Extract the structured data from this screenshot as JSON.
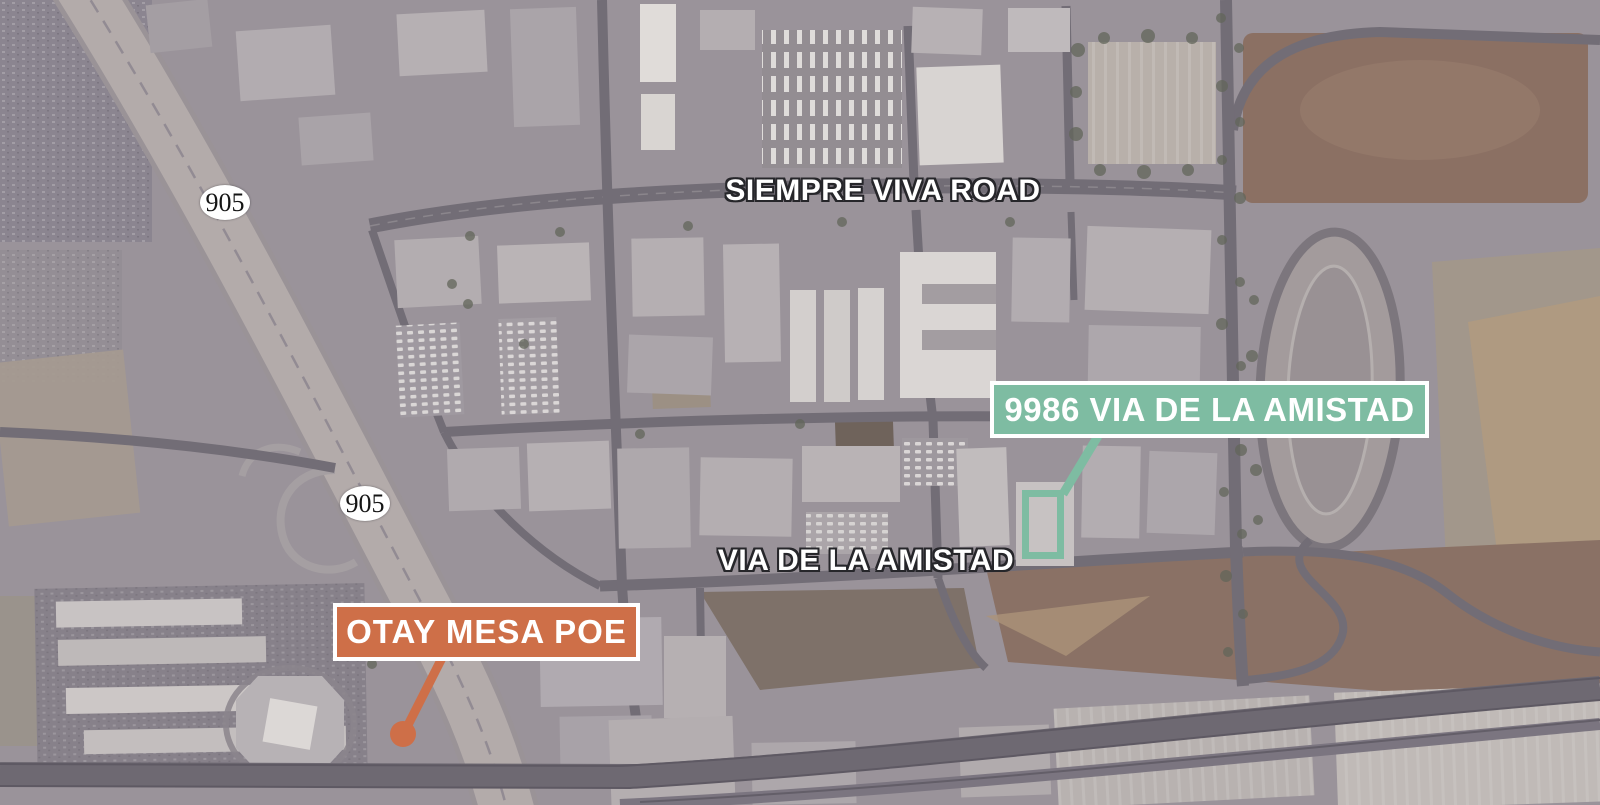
{
  "map": {
    "type": "aerial-satellite",
    "street_labels": [
      {
        "id": "siempre-viva-road",
        "name": "SIEMPRE VIVA ROAD"
      },
      {
        "id": "via-de-la-amistad",
        "name": "VIA DE LA AMISTAD"
      }
    ],
    "route_shields": [
      {
        "number": "905"
      },
      {
        "number": "905"
      }
    ],
    "annotations": {
      "property": {
        "label": "9986 VIA DE LA AMISTAD"
      },
      "poe": {
        "label": "OTAY MESA POE"
      }
    }
  },
  "colors": {
    "teal": "#7EBCA2",
    "orange": "#CE6F48",
    "label_text": "#FFFFFF",
    "halo": "#26262A",
    "shield_fill": "#FFFFFF",
    "shield_text": "#151515"
  }
}
